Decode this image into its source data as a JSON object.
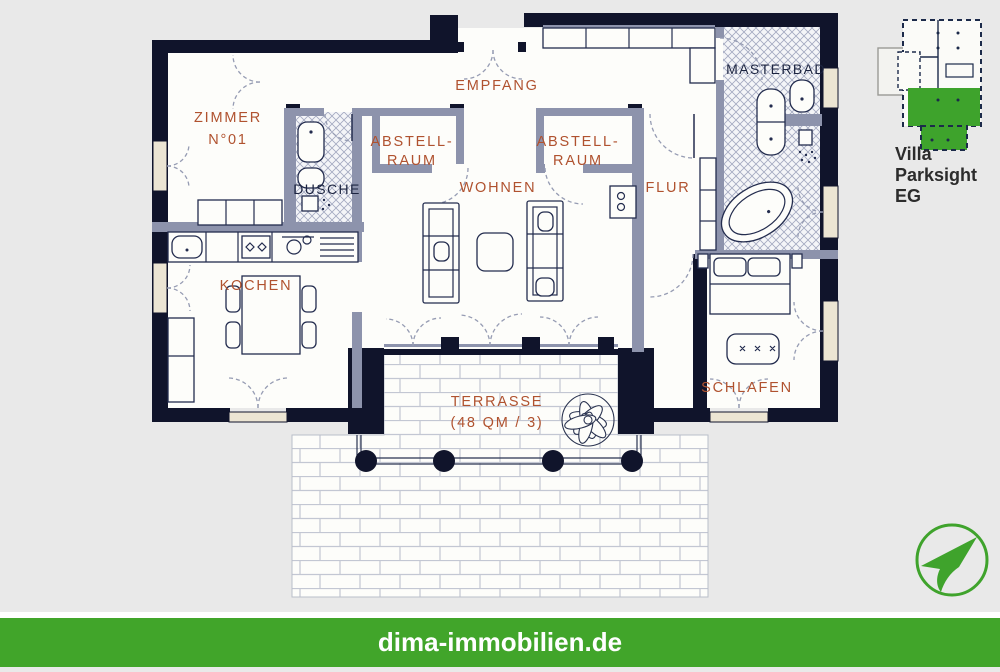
{
  "rooms": {
    "zimmer": {
      "line1": "ZIMMER",
      "line2": "N°01"
    },
    "empfang": {
      "label": "EMPFANG"
    },
    "masterbad": {
      "label": "MASTERBAD"
    },
    "abstell_left": {
      "line1": "ABSTELL-",
      "line2": "RAUM"
    },
    "abstell_right": {
      "line1": "ABSTELL-",
      "line2": "RAUM"
    },
    "dusche": {
      "label": "DUSCHE"
    },
    "wohnen": {
      "label": "WOHNEN"
    },
    "flur": {
      "label": "FLUR"
    },
    "kochen": {
      "label": "KOCHEN"
    },
    "schlafen": {
      "label": "SCHLAFEN"
    },
    "terrasse": {
      "line1": "TERRASSE",
      "line2": "(48 QM / 3)"
    }
  },
  "sidebar": {
    "title": "Villa Parksight EG"
  },
  "footer": {
    "website": "dima-immobilien.de"
  },
  "logo": {
    "icon": "paper-plane"
  },
  "colors": {
    "accent_green": "#41a52a",
    "logo_green": "#3fa32c",
    "wall_navy": "#10142b",
    "interior_wall_gray": "#8d93ac",
    "label_rust": "#b0522f",
    "label_navy": "#1c2440",
    "window_cream": "#ece5d3",
    "canvas_gray": "#e9e9e9",
    "paper_white": "#fdfdfa"
  }
}
